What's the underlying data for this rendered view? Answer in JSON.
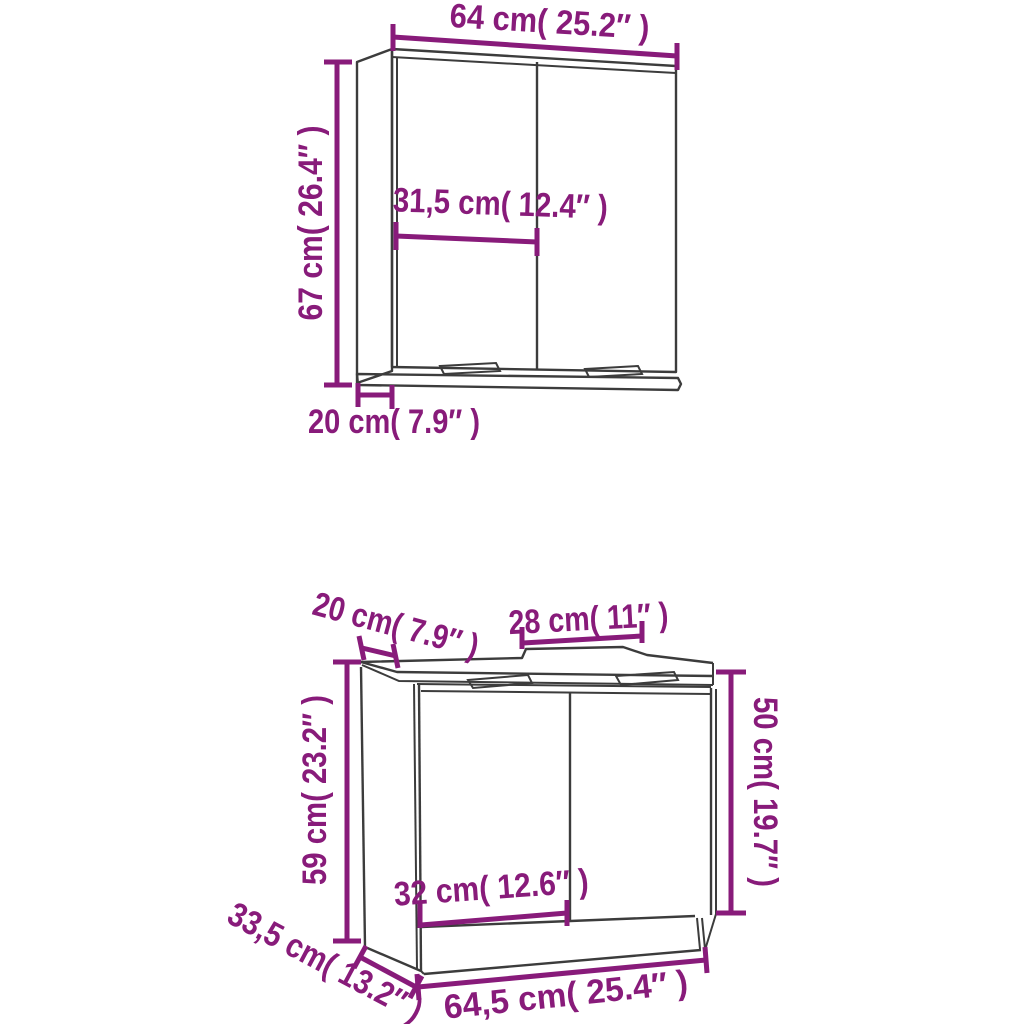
{
  "diagram_title": "Bathroom furniture set dimension diagram",
  "colors": {
    "dimension_annotation": "#881b7a",
    "drawing_line": "#3c3c3c",
    "background": "#ffffff"
  },
  "mirror_cabinet": {
    "width_label": "64 cm( 25.2″ )",
    "height_label": "67 cm( 26.4″ )",
    "inner_width_label": "31,5 cm( 12.4″ )",
    "depth_label": "20 cm( 7.9″ )"
  },
  "sink_cabinet": {
    "top_depth_label": "20 cm( 7.9″ )",
    "cutout_width_label": "28 cm( 11″ )",
    "height_label": "59 cm( 23.2″ )",
    "door_height_label": "50 cm( 19.7″ )",
    "inner_width_label": "32 cm( 12.6″ )",
    "side_depth_label": "33,5 cm( 13.2″ )",
    "width_label": "64,5 cm( 25.4″ )"
  }
}
